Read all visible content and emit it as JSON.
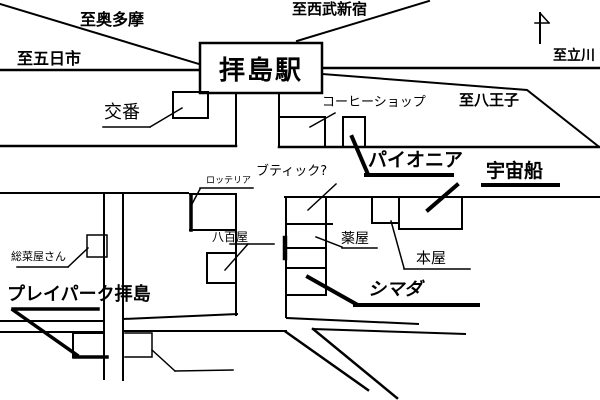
{
  "map": {
    "background": "#ffffff",
    "ink_color": "#000000",
    "station": {
      "label": "拝島駅"
    },
    "directions": [
      {
        "id": "okutama",
        "label": "至奥多摩"
      },
      {
        "id": "itsukaichi",
        "label": "至五日市"
      },
      {
        "id": "seibu-shinjuku",
        "label": "至西武新宿"
      },
      {
        "id": "tachikawa",
        "label": "至立川"
      },
      {
        "id": "hachioji",
        "label": "至八王子"
      }
    ],
    "places": [
      {
        "id": "koban",
        "label": "交番"
      },
      {
        "id": "coffee-shop",
        "label": "コーヒーショップ"
      },
      {
        "id": "pioneer",
        "label": "パイオニア"
      },
      {
        "id": "boutique",
        "label": "ブティック?"
      },
      {
        "id": "spaceship",
        "label": "宇宙船"
      },
      {
        "id": "lotteria",
        "label": "ロッテリア"
      },
      {
        "id": "greengrocer",
        "label": "八百屋"
      },
      {
        "id": "deli",
        "label": "総菜屋さん"
      },
      {
        "id": "pharmacy",
        "label": "薬屋"
      },
      {
        "id": "bookstore",
        "label": "本屋"
      },
      {
        "id": "shimada",
        "label": "シマダ"
      },
      {
        "id": "playpark",
        "label": "プレイパーク拝島"
      }
    ],
    "icons": {
      "north_arrow": "north-arrow"
    }
  }
}
